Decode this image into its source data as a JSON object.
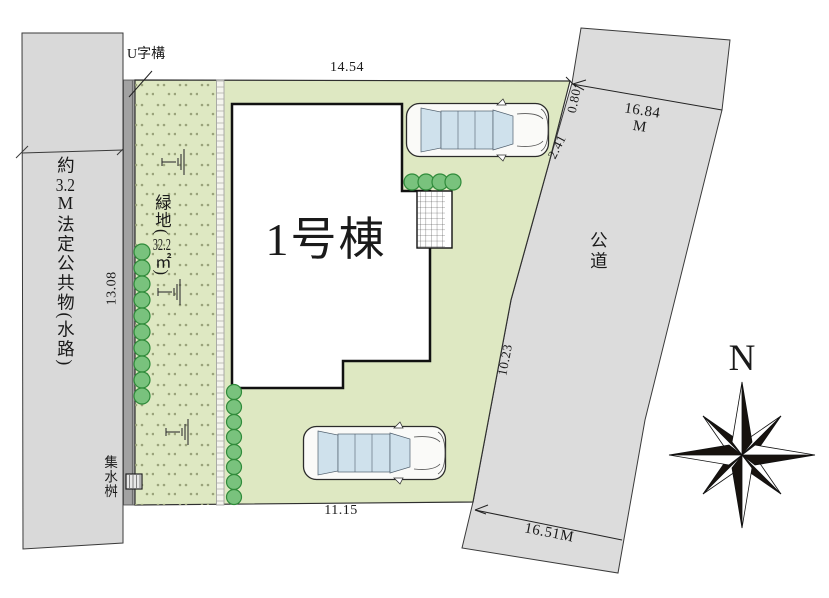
{
  "colors": {
    "lot_green": "#dee8c2",
    "left_road_gray": "#d9d9d9",
    "road_gray": "#dcdcdc",
    "channel_gray": "#a2a2a2",
    "tree_fill": "#79c27d",
    "tree_stroke": "#2f8b3a",
    "glass_blue": "#cfe1ec",
    "compass_black": "#17120e"
  },
  "left_waterway": {
    "label": {
      "prefix": "約",
      "width_value": "3.2",
      "unit": "M",
      "body": "法定公共物",
      "paren_open": "(",
      "note": "水路",
      "paren_close": ")"
    },
    "dim_length": "13.08",
    "catch_basin": "集水桝",
    "u_gutter": "U字構"
  },
  "green_space": {
    "name": "緑地",
    "paren_open": "(",
    "area_value": "32.2",
    "area_unit": "㎡",
    "paren_close": ")"
  },
  "lot": {
    "dim_top": "14.54",
    "dim_bottom": "11.15",
    "dim_right_upper": "0.80",
    "dim_right_mid": "2.41",
    "dim_right_lower": "10.23"
  },
  "building": {
    "label": "1号棟"
  },
  "public_road": {
    "label": "公道",
    "frontage_upper_value": "16.84",
    "frontage_upper_unit": "M",
    "frontage_lower": "16.51M"
  },
  "compass": {
    "north_label": "N"
  }
}
